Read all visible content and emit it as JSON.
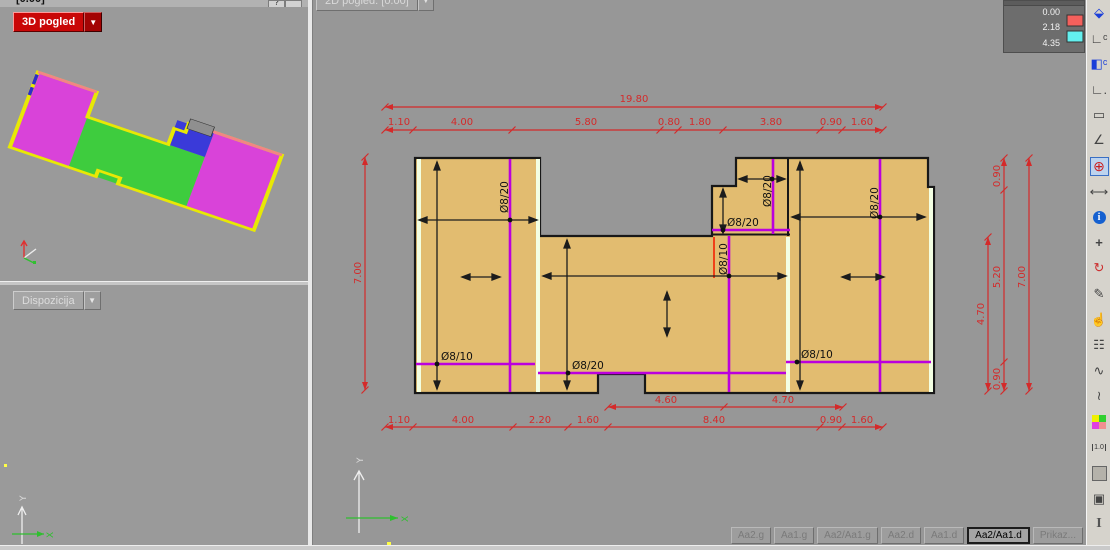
{
  "left_top_panel": {
    "title": "[0.00]",
    "help_button": "?",
    "view_selector": "3D pogled",
    "dropdown_glyph": "▼"
  },
  "left_bottom_panel": {
    "view_selector": "Dispozicija",
    "dropdown_glyph": "▼"
  },
  "main_panel": {
    "view_selector": "2D pogled: [0.00]",
    "dropdown_glyph": "▼"
  },
  "axes": {
    "x_label": "X",
    "y_label": "Y"
  },
  "legend": {
    "values": [
      "0.00",
      "2.18",
      "4.35"
    ],
    "band_colors": [
      "#f4605c",
      "#63f0ef"
    ]
  },
  "plan": {
    "slab_color": "#e2bc70",
    "rebar_color": "#bb00dd",
    "rebar_labels": {
      "left_vertical": "Ø8/20",
      "left_horizontal": "Ø8/10",
      "middle_horizontal": "Ø8/20",
      "middle_red_vertical": "Ø8/10",
      "block_vertical": "Ø8/20",
      "block_horizontal": "Ø8/20",
      "right_vertical": "Ø8/20",
      "right_horizontal": "Ø8/10"
    },
    "dimensions": {
      "color": "#d42a2a",
      "top_total": "19.80",
      "top_segments": [
        "1.10",
        "4.00",
        "5.80",
        "0.80",
        "1.80",
        "3.80",
        "0.90",
        "1.60"
      ],
      "bottom_inner": [
        "4.60",
        "4.70"
      ],
      "bottom_segments": [
        "1.10",
        "4.00",
        "2.20",
        "1.60",
        "8.40",
        "0.90",
        "1.60"
      ],
      "left_total": "7.00",
      "right_inner": "4.70",
      "right_segments": [
        "0.90",
        "5.20",
        "0.90"
      ],
      "right_total": "7.00"
    }
  },
  "toolbar": {
    "icons": [
      {
        "name": "view-3d-icon",
        "glyph": "⬙"
      },
      {
        "name": "section-c-icon",
        "glyph": "∟ᶜ"
      },
      {
        "name": "view-c-icon",
        "glyph": "◧ᶜ"
      },
      {
        "name": "detail-view-icon",
        "glyph": "∟."
      },
      {
        "name": "select-rect-icon",
        "glyph": "▭"
      },
      {
        "name": "angle-icon",
        "glyph": "∠"
      },
      {
        "name": "snap-target-icon",
        "glyph": "⊕"
      },
      {
        "name": "dimension-icon",
        "glyph": "⟷"
      },
      {
        "name": "info-icon",
        "glyph": "i"
      },
      {
        "name": "move-icon",
        "glyph": "+"
      },
      {
        "name": "rotate-icon",
        "glyph": "↻"
      },
      {
        "name": "draw-rebar-icon",
        "glyph": "✎"
      },
      {
        "name": "pan-hand-icon",
        "glyph": "☝"
      },
      {
        "name": "text-grid-icon",
        "glyph": "☷"
      },
      {
        "name": "rebar-wave-icon",
        "glyph": "∿"
      },
      {
        "name": "rebar-edit-icon",
        "glyph": "≀"
      },
      {
        "name": "color-areas-icon",
        "glyph": ""
      },
      {
        "name": "scale-dim-icon",
        "glyph": "1.0"
      },
      {
        "name": "fill-area-icon",
        "glyph": ""
      },
      {
        "name": "solid-box-icon",
        "glyph": "▣"
      },
      {
        "name": "beam-profile-icon",
        "glyph": "I"
      },
      {
        "name": "tree-icon",
        "glyph": "♣"
      }
    ]
  },
  "tabs": [
    {
      "label": "Aa2.g",
      "active": false
    },
    {
      "label": "Aa1.g",
      "active": false
    },
    {
      "label": "Aa2/Aa1.g",
      "active": false
    },
    {
      "label": "Aa2.d",
      "active": false
    },
    {
      "label": "Aa1.d",
      "active": false
    },
    {
      "label": "Aa2/Aa1.d",
      "active": true
    },
    {
      "label": "Prikaz...",
      "active": false
    }
  ]
}
